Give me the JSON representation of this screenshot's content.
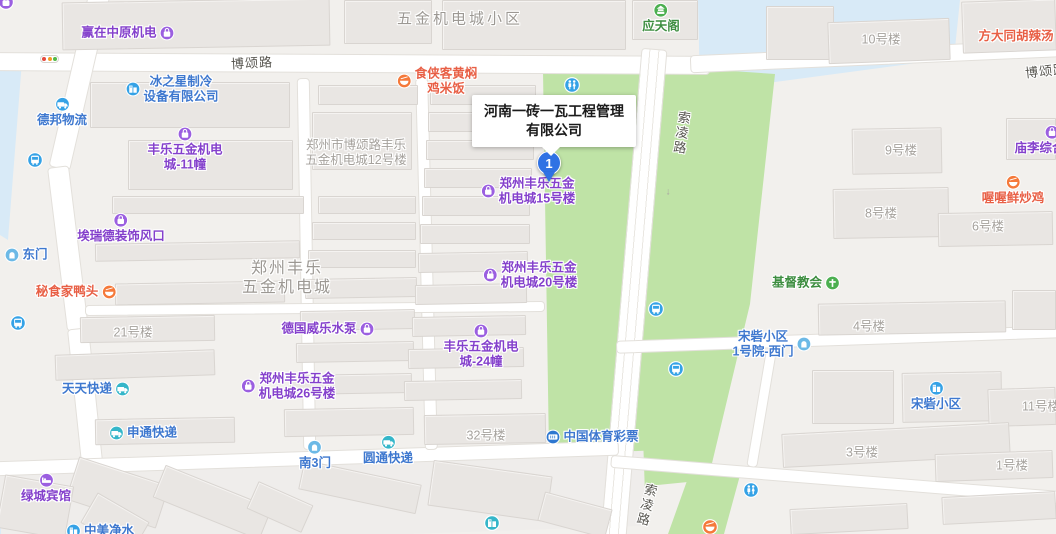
{
  "map": {
    "callout": {
      "line1": "河南一砖一瓦工程管理",
      "line2": "有限公司"
    },
    "marker": {
      "label": "1"
    },
    "palettes": {
      "purple": {
        "icon": "#9b5fe0",
        "text": "#8440cc"
      },
      "blue": {
        "icon": "#35a2e6",
        "text": "#3e78cf"
      },
      "teal": {
        "icon": "#35b6c9",
        "text": "#3e78cf"
      },
      "orange": {
        "icon": "#f5793a",
        "text": "#e85f45"
      },
      "green": {
        "icon": "#4caf50",
        "text": "#3e8e41"
      },
      "gate": {
        "icon": "#6cb9e6",
        "text": "#3e78cf"
      },
      "lottery": {
        "icon": "#2e77d0",
        "text": "#3e78cf"
      }
    },
    "pois": [
      {
        "name": "poi-yingzai-zhongyuan",
        "lines": [
          "赢在中原机电"
        ],
        "cx": 128,
        "cy": 33,
        "icon": "bag",
        "side": "right",
        "palette": "purple"
      },
      {
        "name": "poi-yingtian-ge",
        "lines": [
          "应天阁"
        ],
        "cx": 661,
        "cy": 18,
        "icon": "pavilion",
        "side": "top",
        "palette": "green"
      },
      {
        "name": "poi-fangda-hulatang",
        "lines": [
          "方大同胡辣汤"
        ],
        "cx": 1016,
        "cy": 36,
        "icon": "",
        "side": "none",
        "palette": "orange"
      },
      {
        "name": "poi-shixiake",
        "lines": [
          "食侠客黄焖",
          "鸡米饭"
        ],
        "cx": 437,
        "cy": 81,
        "icon": "bowl",
        "side": "left",
        "palette": "orange"
      },
      {
        "name": "poi-bingzhixing",
        "lines": [
          "冰之星制冷",
          "设备有限公司"
        ],
        "cx": 172,
        "cy": 89,
        "icon": "building",
        "side": "left",
        "palette": "blue"
      },
      {
        "name": "poi-debang-wuliu",
        "lines": [
          "德邦物流"
        ],
        "cx": 62,
        "cy": 112,
        "icon": "truck",
        "side": "top",
        "palette": "blue"
      },
      {
        "name": "poi-fengle-11",
        "lines": [
          "丰乐五金机电",
          "城-11幢"
        ],
        "cx": 185,
        "cy": 149,
        "icon": "bag",
        "side": "top",
        "palette": "purple"
      },
      {
        "name": "poi-miaoli-market",
        "lines": [
          "庙李综合市场"
        ],
        "cx": 1052,
        "cy": 140,
        "icon": "bag",
        "side": "top",
        "palette": "purple"
      },
      {
        "name": "poi-wowo-chicken",
        "lines": [
          "喔喔鲜炒鸡"
        ],
        "cx": 1013,
        "cy": 190,
        "icon": "bowl",
        "side": "top",
        "palette": "orange"
      },
      {
        "name": "poi-airuide",
        "lines": [
          "埃瑞德装饰风口"
        ],
        "cx": 121,
        "cy": 228,
        "icon": "bag",
        "side": "top",
        "palette": "purple"
      },
      {
        "name": "poi-dongmen",
        "lines": [
          "东门"
        ],
        "cx": 26,
        "cy": 255,
        "icon": "door",
        "side": "left",
        "palette": "gate"
      },
      {
        "name": "poi-mishijia-duck",
        "lines": [
          "秘食家鸭头"
        ],
        "cx": 76,
        "cy": 292,
        "icon": "bowl",
        "side": "right",
        "palette": "orange"
      },
      {
        "name": "poi-zhengzhou-fengle-15",
        "lines": [
          "郑州丰乐五金",
          "机电城15号楼"
        ],
        "cx": 528,
        "cy": 191,
        "icon": "bag",
        "side": "left",
        "palette": "purple"
      },
      {
        "name": "poi-zhengzhou-fengle-20",
        "lines": [
          "郑州丰乐五金",
          "机电城20号楼"
        ],
        "cx": 530,
        "cy": 275,
        "icon": "bag",
        "side": "left",
        "palette": "purple"
      },
      {
        "name": "poi-jidu-church",
        "lines": [
          "基督教会"
        ],
        "cx": 806,
        "cy": 283,
        "icon": "cross",
        "side": "right",
        "palette": "green"
      },
      {
        "name": "poi-deguo-weile-pump",
        "lines": [
          "德国威乐水泵"
        ],
        "cx": 328,
        "cy": 329,
        "icon": "bag",
        "side": "right",
        "palette": "purple"
      },
      {
        "name": "poi-fengle-24",
        "lines": [
          "丰乐五金机电",
          "城-24幢"
        ],
        "cx": 481,
        "cy": 346,
        "icon": "bag",
        "side": "top",
        "palette": "purple"
      },
      {
        "name": "poi-songzhai-ximen",
        "lines": [
          "宋砦小区",
          "1号院-西门"
        ],
        "cx": 772,
        "cy": 344,
        "icon": "door",
        "side": "right",
        "palette": "gate"
      },
      {
        "name": "poi-tiantian-express",
        "lines": [
          "天天快递"
        ],
        "cx": 96,
        "cy": 389,
        "icon": "truck",
        "side": "right",
        "palette": "teal"
      },
      {
        "name": "poi-zhengzhou-fengle-26",
        "lines": [
          "郑州丰乐五金",
          "机电城26号楼"
        ],
        "cx": 288,
        "cy": 386,
        "icon": "bag",
        "side": "left",
        "palette": "purple"
      },
      {
        "name": "poi-songzhai-xiaoqu",
        "lines": [
          "宋砦小区"
        ],
        "cx": 936,
        "cy": 396,
        "icon": "building",
        "side": "top",
        "palette": "blue"
      },
      {
        "name": "poi-shentong-express",
        "lines": [
          "申通快递"
        ],
        "cx": 143,
        "cy": 433,
        "icon": "truck",
        "side": "left",
        "palette": "teal"
      },
      {
        "name": "poi-zhongguo-ticai",
        "lines": [
          "中国体育彩票"
        ],
        "cx": 592,
        "cy": 437,
        "icon": "ticket",
        "side": "left",
        "palette": "lottery"
      },
      {
        "name": "poi-yuantong-express",
        "lines": [
          "圆通快递"
        ],
        "cx": 388,
        "cy": 450,
        "icon": "truck",
        "side": "top",
        "palette": "teal"
      },
      {
        "name": "poi-nan3men",
        "lines": [
          "南3门"
        ],
        "cx": 315,
        "cy": 455,
        "icon": "door",
        "side": "top",
        "palette": "gate"
      },
      {
        "name": "poi-lvcheng-hotel",
        "lines": [
          "绿城宾馆"
        ],
        "cx": 46,
        "cy": 488,
        "icon": "bed",
        "side": "top",
        "palette": "purple"
      },
      {
        "name": "poi-zhongmei-water",
        "lines": [
          "中美净水"
        ],
        "cx": 100,
        "cy": 531,
        "icon": "building",
        "side": "left",
        "palette": "blue"
      }
    ],
    "building_labels": [
      {
        "name": "label-12haolou",
        "lines": [
          "郑州市博颂路丰乐",
          "五金机电城12号楼"
        ],
        "cx": 356,
        "cy": 153
      },
      {
        "name": "label-10haolou",
        "lines": [
          "10号楼"
        ],
        "cx": 881,
        "cy": 40
      },
      {
        "name": "label-9haolou",
        "lines": [
          "9号楼"
        ],
        "cx": 901,
        "cy": 151
      },
      {
        "name": "label-8haolou",
        "lines": [
          "8号楼"
        ],
        "cx": 881,
        "cy": 214
      },
      {
        "name": "label-6haolou",
        "lines": [
          "6号楼"
        ],
        "cx": 988,
        "cy": 227
      },
      {
        "name": "label-21haolou",
        "lines": [
          "21号楼"
        ],
        "cx": 133,
        "cy": 333
      },
      {
        "name": "label-4haolou",
        "lines": [
          "4号楼"
        ],
        "cx": 869,
        "cy": 327
      },
      {
        "name": "label-32haolou",
        "lines": [
          "32号楼"
        ],
        "cx": 486,
        "cy": 436
      },
      {
        "name": "label-11haolou",
        "lines": [
          "11号楼"
        ],
        "cx": 1041,
        "cy": 407
      },
      {
        "name": "label-3haolou",
        "lines": [
          "3号楼"
        ],
        "cx": 862,
        "cy": 453
      },
      {
        "name": "label-1haolou",
        "lines": [
          "1号楼"
        ],
        "cx": 1012,
        "cy": 466
      }
    ],
    "area_labels": [
      {
        "name": "area-wujin-jidiancheng-xiaoqu",
        "lines": [
          "五金机电城小区"
        ],
        "cx": 460,
        "cy": 19,
        "big": false
      },
      {
        "name": "area-zhengzhou-fengle-city",
        "lines": [
          "郑州丰乐",
          "五金机电城"
        ],
        "cx": 287,
        "cy": 278,
        "big": true
      }
    ],
    "road_labels": [
      {
        "name": "road-label-bosong-1",
        "text": "博颂路",
        "cx": 252,
        "cy": 62,
        "vert": false,
        "rot": -3
      },
      {
        "name": "road-label-bosong-2",
        "text": "博颂路",
        "cx": 1046,
        "cy": 70,
        "vert": false,
        "rot": -6
      },
      {
        "name": "road-label-suoling-1",
        "text": "索凌路",
        "cx": 681,
        "cy": 133,
        "vert": true,
        "rot": 8
      },
      {
        "name": "road-label-suoling-2",
        "text": "索凌路",
        "cx": 646,
        "cy": 505,
        "vert": true,
        "rot": 14
      }
    ],
    "transit_icons": [
      {
        "name": "bus-stop-icon-1",
        "type": "bus",
        "x": 35,
        "y": 160,
        "color": "#35a2e6",
        "clickable": true
      },
      {
        "name": "bus-stop-icon-2",
        "type": "bus",
        "x": 18,
        "y": 323,
        "color": "#35a2e6",
        "clickable": true
      },
      {
        "name": "bus-stop-icon-3",
        "type": "bus",
        "x": 656,
        "y": 309,
        "color": "#35a2e6",
        "clickable": true
      },
      {
        "name": "bus-stop-icon-4",
        "type": "bus",
        "x": 676,
        "y": 369,
        "color": "#35a2e6",
        "clickable": true
      },
      {
        "name": "toilet-icon-1",
        "type": "toilet",
        "x": 572,
        "y": 85,
        "color": "#35a2e6",
        "clickable": true
      },
      {
        "name": "toilet-icon-2",
        "type": "toilet",
        "x": 751,
        "y": 490,
        "color": "#35a2e6",
        "clickable": true
      },
      {
        "name": "poi-icon-corner",
        "type": "bag",
        "x": 6,
        "y": 2,
        "color": "#9b5fe0",
        "clickable": true
      },
      {
        "name": "building-icon-bottom",
        "type": "building",
        "x": 492,
        "y": 523,
        "color": "#35b6c9",
        "clickable": true
      },
      {
        "name": "food-icon-bottom",
        "type": "bowl",
        "x": 710,
        "y": 527,
        "color": "#f5793a",
        "clickable": true
      }
    ],
    "road_arrow": {
      "name": "road-direction-arrow",
      "glyph": "↓",
      "x": 668,
      "y": 192
    }
  }
}
